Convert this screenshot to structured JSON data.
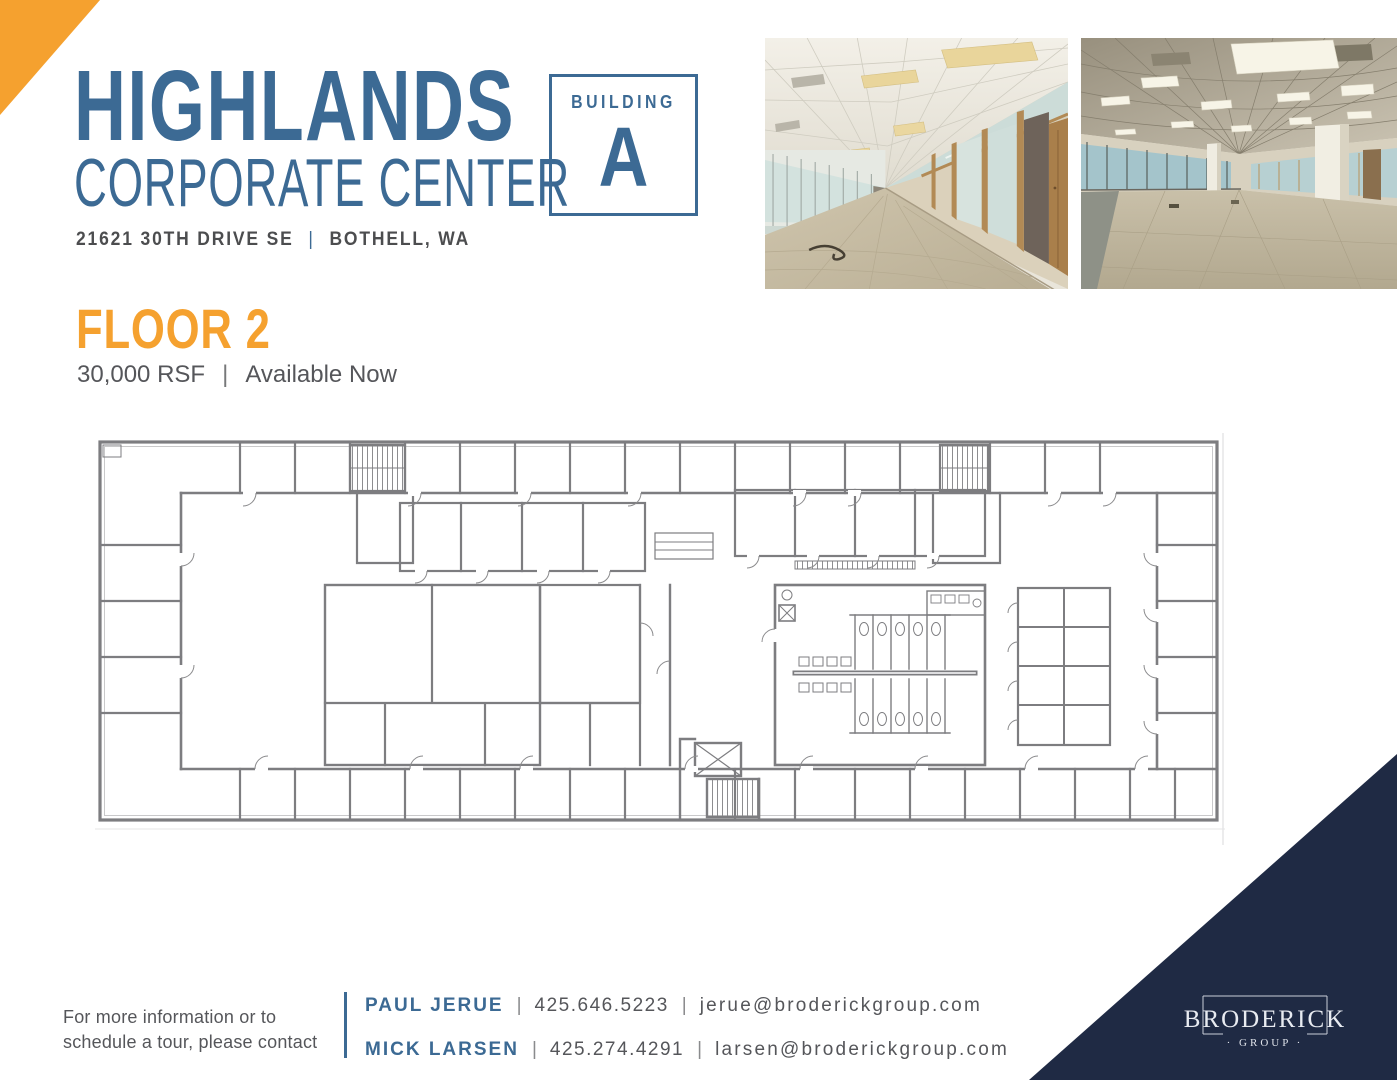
{
  "colors": {
    "brand_blue": "#3C6A94",
    "accent_orange": "#F5A12F",
    "navy": "#1F2A44",
    "text_gray": "#55565A",
    "plan_line_gray": "#7D7D80"
  },
  "header": {
    "title": "HIGHLANDS",
    "subtitle": "CORPORATE CENTER",
    "address_street": "21621 30TH DRIVE SE",
    "address_separator": "|",
    "address_city": "BOTHELL, WA",
    "building_box": {
      "label": "BUILDING",
      "letter": "A"
    }
  },
  "floor_section": {
    "title": "FLOOR 2",
    "rsf": "30,000 RSF",
    "separator": "|",
    "availability": "Available Now"
  },
  "footer": {
    "note_line1": "For more information or to",
    "note_line2": "schedule a tour, please contact",
    "separator": "|",
    "contacts": [
      {
        "name": "PAUL JERUE",
        "phone": "425.646.5223",
        "email": "jerue@broderickgroup.com"
      },
      {
        "name": "MICK LARSEN",
        "phone": "425.274.4291",
        "email": "larsen@broderickgroup.com"
      }
    ]
  },
  "logo": {
    "brand": "BRODERICK",
    "sub": "· GROUP ·"
  }
}
